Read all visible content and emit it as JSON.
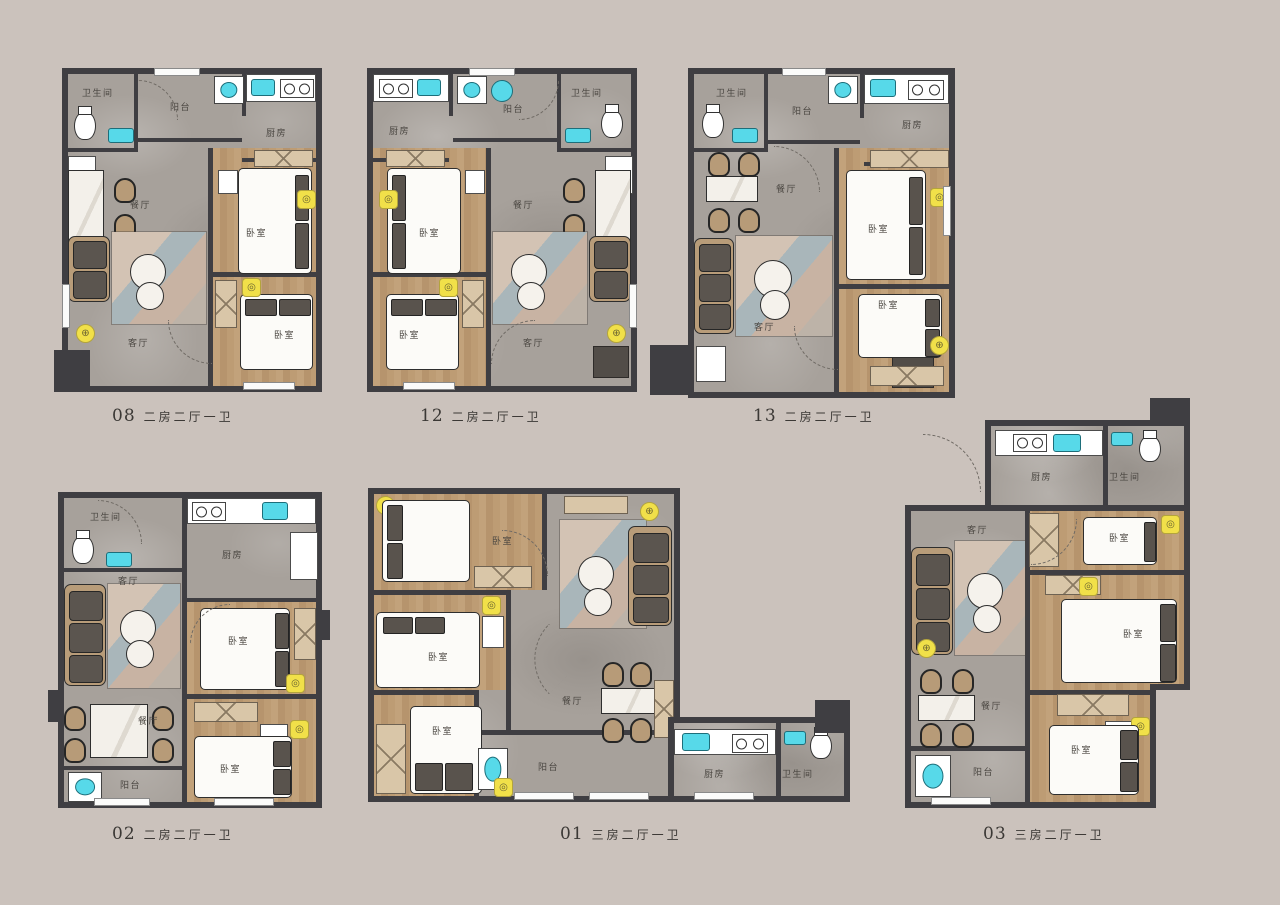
{
  "colors": {
    "background": "#cbc2bc",
    "wall": "#3f3e42",
    "floor_gray": "#a7a19b",
    "floor_wood": "#bb9870",
    "accent_cyan": "#57d9e9",
    "accent_yellow": "#f1e049",
    "furniture_dark": "#59534d",
    "furniture_tan": "#b89c79"
  },
  "icons": {
    "target": "⊕",
    "lamp": "◎"
  },
  "plans": [
    {
      "id": "08",
      "type": "二房二厅一卫",
      "rooms": {
        "bathroom": "卫生间",
        "balcony": "阳台",
        "kitchen": "厨房",
        "dining": "餐厅",
        "living": "客厅",
        "bedroom1": "卧室",
        "bedroom2": "卧室"
      }
    },
    {
      "id": "12",
      "type": "二房二厅一卫",
      "rooms": {
        "bathroom": "卫生间",
        "balcony": "阳台",
        "kitchen": "厨房",
        "dining": "餐厅",
        "living": "客厅",
        "bedroom1": "卧室",
        "bedroom2": "卧室"
      }
    },
    {
      "id": "13",
      "type": "二房二厅一卫",
      "rooms": {
        "bathroom": "卫生间",
        "balcony": "阳台",
        "kitchen": "厨房",
        "dining": "餐厅",
        "living": "客厅",
        "bedroom1": "卧室",
        "bedroom2": "卧室"
      }
    },
    {
      "id": "02",
      "type": "二房二厅一卫",
      "rooms": {
        "bathroom": "卫生间",
        "balcony": "阳台",
        "kitchen": "厨房",
        "dining": "餐厅",
        "living": "客厅",
        "bedroom1": "卧室",
        "bedroom2": "卧室"
      }
    },
    {
      "id": "01",
      "type": "三房二厅一卫",
      "rooms": {
        "bathroom": "卫生间",
        "balcony": "阳台",
        "kitchen": "厨房",
        "dining": "餐厅",
        "living": "客厅",
        "bedroom1": "卧室",
        "bedroom2": "卧室",
        "bedroom3": "卧室"
      }
    },
    {
      "id": "03",
      "type": "三房二厅一卫",
      "rooms": {
        "bathroom": "卫生间",
        "balcony": "阳台",
        "kitchen": "厨房",
        "dining": "餐厅",
        "living": "客厅",
        "bedroom1": "卧室",
        "bedroom2": "卧室",
        "bedroom3": "卧室"
      }
    }
  ]
}
